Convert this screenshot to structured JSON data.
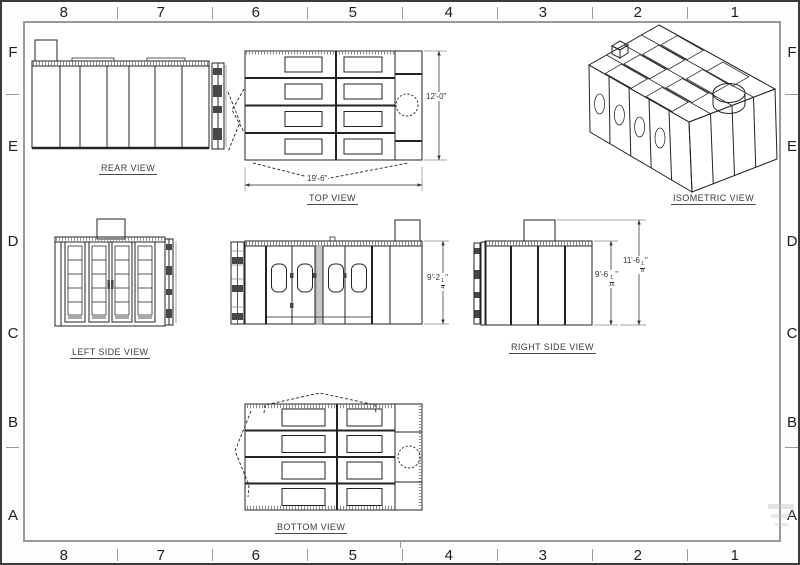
{
  "drawing": {
    "border": {
      "top_zones": [
        "8",
        "7",
        "6",
        "5",
        "4",
        "3",
        "2",
        "1"
      ],
      "bottom_zones": [
        "8",
        "7",
        "6",
        "5",
        "4",
        "3",
        "2",
        "1"
      ],
      "left_zones": [
        "F",
        "E",
        "D",
        "C",
        "B",
        "A"
      ],
      "right_zones": [
        "F",
        "E",
        "D",
        "C",
        "B",
        "A"
      ]
    },
    "views": {
      "rear": {
        "label": "REAR VIEW"
      },
      "top": {
        "label": "TOP VIEW",
        "width_dim": "19'-6\"",
        "depth_dim": "12'-0\""
      },
      "isometric": {
        "label": "ISOMETRIC VIEW"
      },
      "left_side": {
        "label": "LEFT SIDE VIEW"
      },
      "front": {
        "height_dim": {
          "main": "9'-2",
          "num": "1",
          "den": "4",
          "unit": "\""
        }
      },
      "right_side": {
        "label": "RIGHT SIDE VIEW",
        "wall_height_dim": {
          "main": "9'-6",
          "num": "1",
          "den": "16",
          "unit": "\""
        },
        "overall_height_dim": {
          "main": "11'-6",
          "num": "1",
          "den": "8",
          "unit": "\""
        }
      },
      "bottom": {
        "label": "BOTTOM VIEW"
      }
    }
  }
}
